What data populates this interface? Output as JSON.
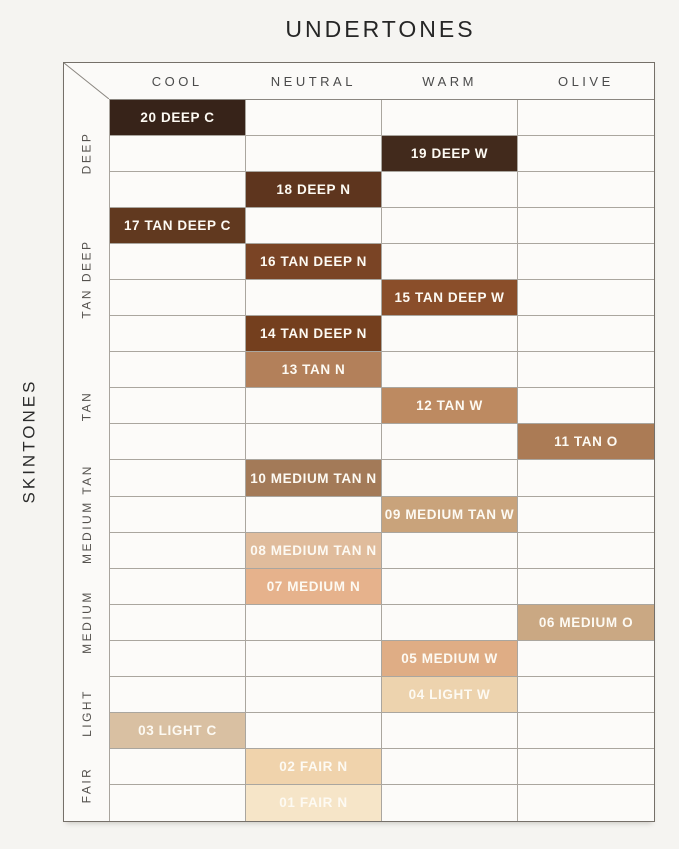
{
  "title": "UNDERTONES",
  "chart_data": {
    "type": "heatmap",
    "title": "UNDERTONES",
    "x_axis_label": "UNDERTONES",
    "y_axis_label": "SKINTONES",
    "columns": [
      "COOL",
      "NEUTRAL",
      "WARM",
      "OLIVE"
    ],
    "row_groups": [
      {
        "label": "DEEP",
        "rows": 3
      },
      {
        "label": "TAN DEEP",
        "rows": 4
      },
      {
        "label": "TAN",
        "rows": 3
      },
      {
        "label": "MEDIUM TAN",
        "rows": 3
      },
      {
        "label": "MEDIUM",
        "rows": 3
      },
      {
        "label": "LIGHT",
        "rows": 2
      },
      {
        "label": "FAIR",
        "rows": 2
      }
    ],
    "shades": [
      {
        "label": "20 DEEP C",
        "undertone": "COOL",
        "group": "DEEP",
        "color": "#372319"
      },
      {
        "label": "19 DEEP W",
        "undertone": "WARM",
        "group": "DEEP",
        "color": "#422a1c"
      },
      {
        "label": "18 DEEP N",
        "undertone": "NEUTRAL",
        "group": "DEEP",
        "color": "#5e351e"
      },
      {
        "label": "17 TAN DEEP C",
        "undertone": "COOL",
        "group": "TAN DEEP",
        "color": "#61391f"
      },
      {
        "label": "16 TAN DEEP N",
        "undertone": "NEUTRAL",
        "group": "TAN DEEP",
        "color": "#7a4425"
      },
      {
        "label": "15 TAN DEEP W",
        "undertone": "WARM",
        "group": "TAN DEEP",
        "color": "#8a4e2a"
      },
      {
        "label": "14 TAN DEEP N",
        "undertone": "NEUTRAL",
        "group": "TAN DEEP",
        "color": "#743f1e"
      },
      {
        "label": "13 TAN N",
        "undertone": "NEUTRAL",
        "group": "TAN",
        "color": "#b3805a"
      },
      {
        "label": "12 TAN W",
        "undertone": "WARM",
        "group": "TAN",
        "color": "#bd8a61"
      },
      {
        "label": "11 TAN O",
        "undertone": "OLIVE",
        "group": "TAN",
        "color": "#ab7b55"
      },
      {
        "label": "10 MEDIUM TAN N",
        "undertone": "NEUTRAL",
        "group": "MEDIUM TAN",
        "color": "#a37a58"
      },
      {
        "label": "09 MEDIUM TAN W",
        "undertone": "WARM",
        "group": "MEDIUM TAN",
        "color": "#c9a37b"
      },
      {
        "label": "08 MEDIUM TAN N",
        "undertone": "NEUTRAL",
        "group": "MEDIUM TAN",
        "color": "#e0bc9c"
      },
      {
        "label": "07 MEDIUM N",
        "undertone": "NEUTRAL",
        "group": "MEDIUM",
        "color": "#e6b28c"
      },
      {
        "label": "06 MEDIUM O",
        "undertone": "OLIVE",
        "group": "MEDIUM",
        "color": "#caa883"
      },
      {
        "label": "05 MEDIUM W",
        "undertone": "WARM",
        "group": "MEDIUM",
        "color": "#dfad85"
      },
      {
        "label": "04 LIGHT W",
        "undertone": "WARM",
        "group": "LIGHT",
        "color": "#edd3ae"
      },
      {
        "label": "03 LIGHT C",
        "undertone": "COOL",
        "group": "LIGHT",
        "color": "#d9c0a2"
      },
      {
        "label": "02 FAIR N",
        "undertone": "NEUTRAL",
        "group": "FAIR",
        "color": "#f0d3ac"
      },
      {
        "label": "01 FAIR N",
        "undertone": "NEUTRAL",
        "group": "FAIR",
        "color": "#f6e5c8"
      }
    ],
    "legend_position": "none",
    "grid": true
  },
  "style": {
    "page_background": "#f5f4f1",
    "cell_background": "#fcfbf9",
    "gridline_color": "#aaa69f",
    "outer_border_color": "#757069",
    "chip_text_color": "#fdfaf3",
    "header_text_color": "#4b4b4b"
  }
}
